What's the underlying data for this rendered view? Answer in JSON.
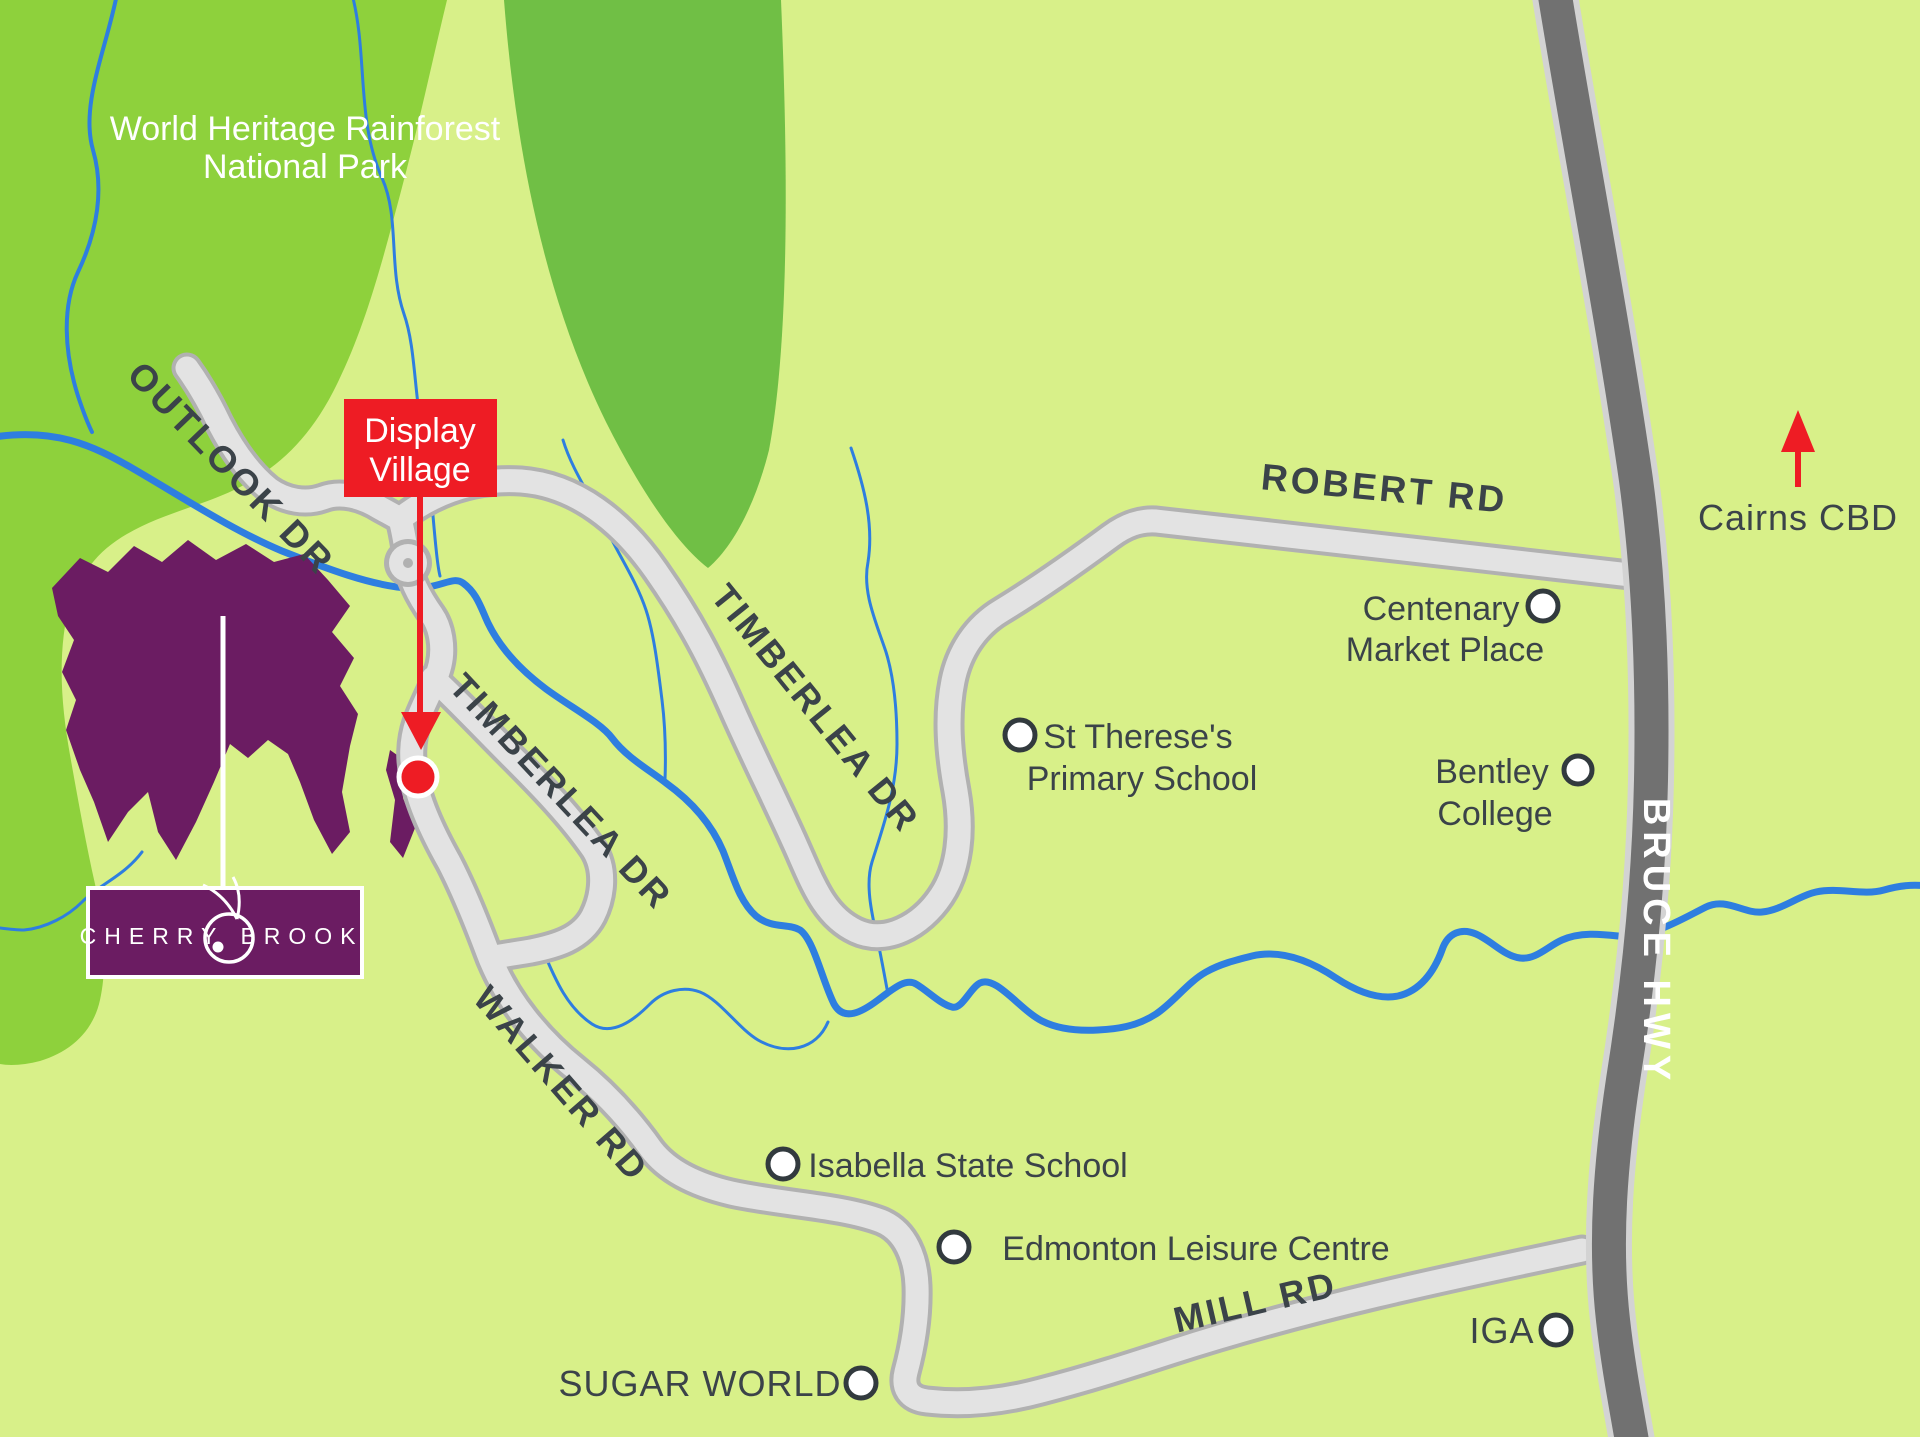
{
  "park": {
    "line1": "World Heritage Rainforest",
    "line2": "National Park"
  },
  "roads": {
    "outlook": "OUTLOOK DR",
    "timberlea_upper": "TIMBERLEA DR",
    "timberlea_lower": "TIMBERLEA DR",
    "robert": "ROBERT RD",
    "walker": "WALKER RD",
    "mill": "MILL RD",
    "bruce": "BRUCE HWY"
  },
  "callout": {
    "line1": "Display",
    "line2": "Village"
  },
  "direction": {
    "label": "Cairns CBD"
  },
  "pois": {
    "st_therese": {
      "line1": "St Therese's",
      "line2": "Primary School"
    },
    "centenary": {
      "line1": "Centenary",
      "line2": "Market Place"
    },
    "bentley": {
      "line1": "Bentley",
      "line2": "College"
    },
    "isabella": {
      "label": "Isabella State School"
    },
    "edmonton": {
      "label": "Edmonton Leisure Centre"
    },
    "iga": {
      "label": "IGA"
    },
    "sugar_world": {
      "label": "SUGAR WORLD"
    }
  },
  "brand": {
    "word1": "CHERRY",
    "word2": "BROOK"
  },
  "colors": {
    "background": "#d8f089",
    "forest": "#8ed13c",
    "forest_dark": "#70bf45",
    "road_fill": "#e3e3e3",
    "road_casing": "#b1b1b1",
    "highway_fill": "#717171",
    "highway_casing": "#d3d3d3",
    "river": "#2e7ee0",
    "label_text": "#3b4349",
    "accent_red": "#ee1c24",
    "brand_purple": "#6b1c62",
    "white": "#ffffff"
  }
}
